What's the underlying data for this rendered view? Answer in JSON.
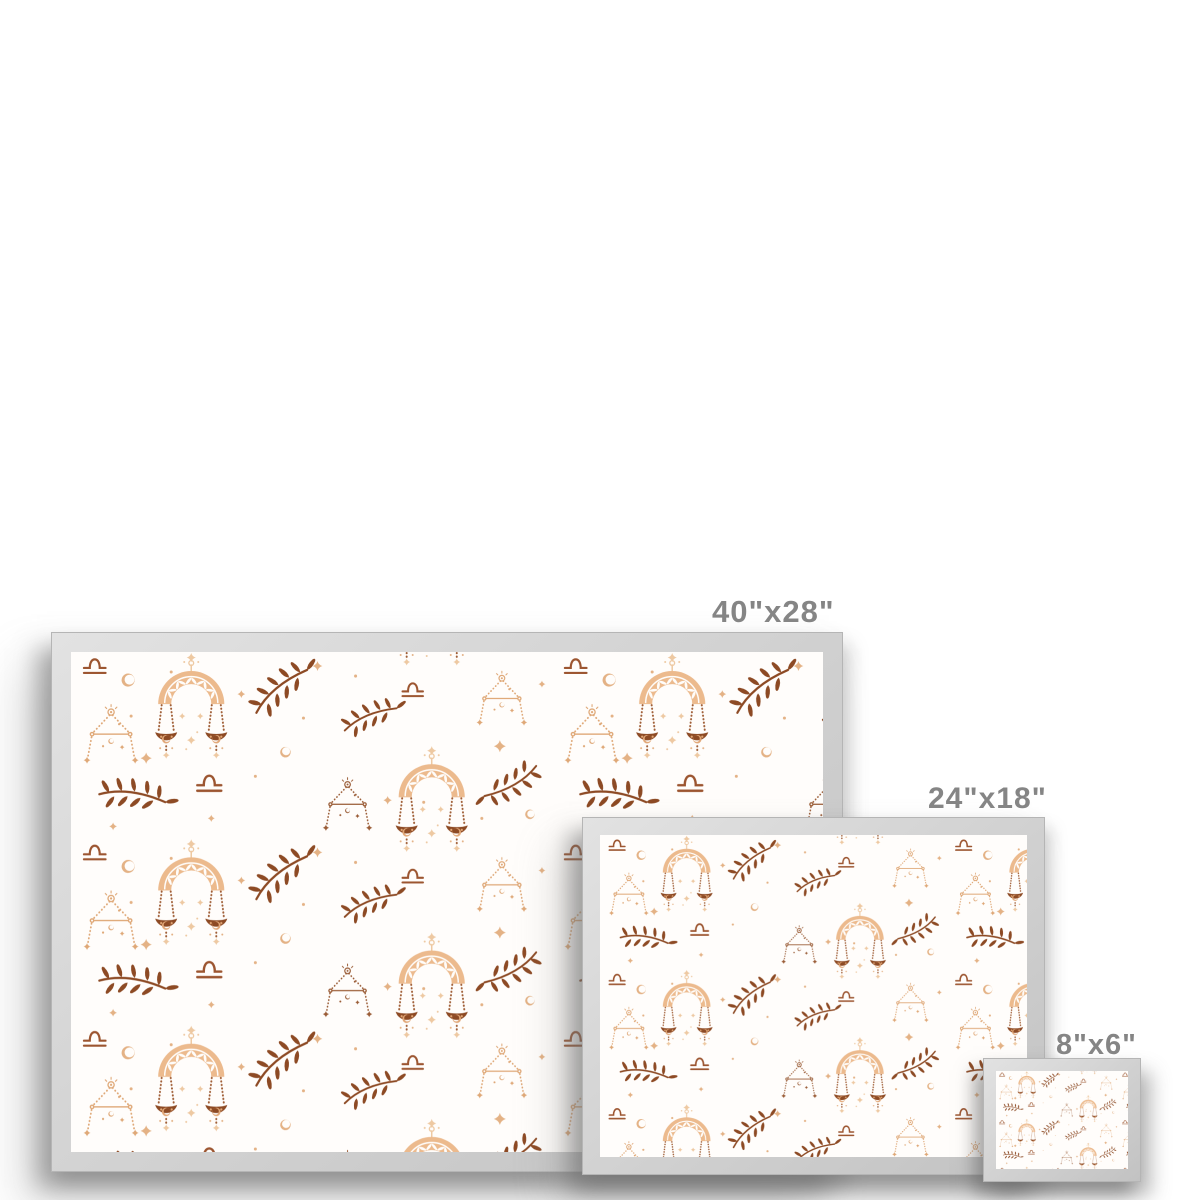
{
  "page": {
    "description": "Framed art print size comparison mockup, Libra zodiac pattern",
    "background": "#ffffff"
  },
  "frames": [
    {
      "id": "large",
      "label": "40\"x28\"",
      "width_in": 40,
      "height_in": 28
    },
    {
      "id": "medium",
      "label": "24\"x18\"",
      "width_in": 24,
      "height_in": 18
    },
    {
      "id": "small",
      "label": "8\"x6\"",
      "width_in": 8,
      "height_in": 6
    }
  ],
  "artwork": {
    "theme": "libra-zodiac-boho-pattern",
    "motifs": [
      "libra-scales-arch-motif",
      "libra-constellation-motif",
      "laurel-branch-motif",
      "libra-glyph-motif",
      "crescent-moon-motif",
      "four-point-star-motif",
      "sparkle-dot-motif"
    ]
  },
  "colors": {
    "paper": "#fffdfb",
    "arch_tan": "#ecba8d",
    "arch_tan_deep": "#e2a878",
    "rust_brown": "#8d4a24",
    "chain_brown": "#a05e36",
    "star_tan": "#eec9a2",
    "star_tan_deep": "#e4b285",
    "constellation_tan": "#dfa877",
    "constellation_brown": "#9a5c36",
    "glyph_brown": "#9c5530",
    "frame_silver": "#d2d2d2",
    "frame_edge": "#b5b5b5",
    "label_gray": "#858585",
    "background": "#ffffff"
  }
}
